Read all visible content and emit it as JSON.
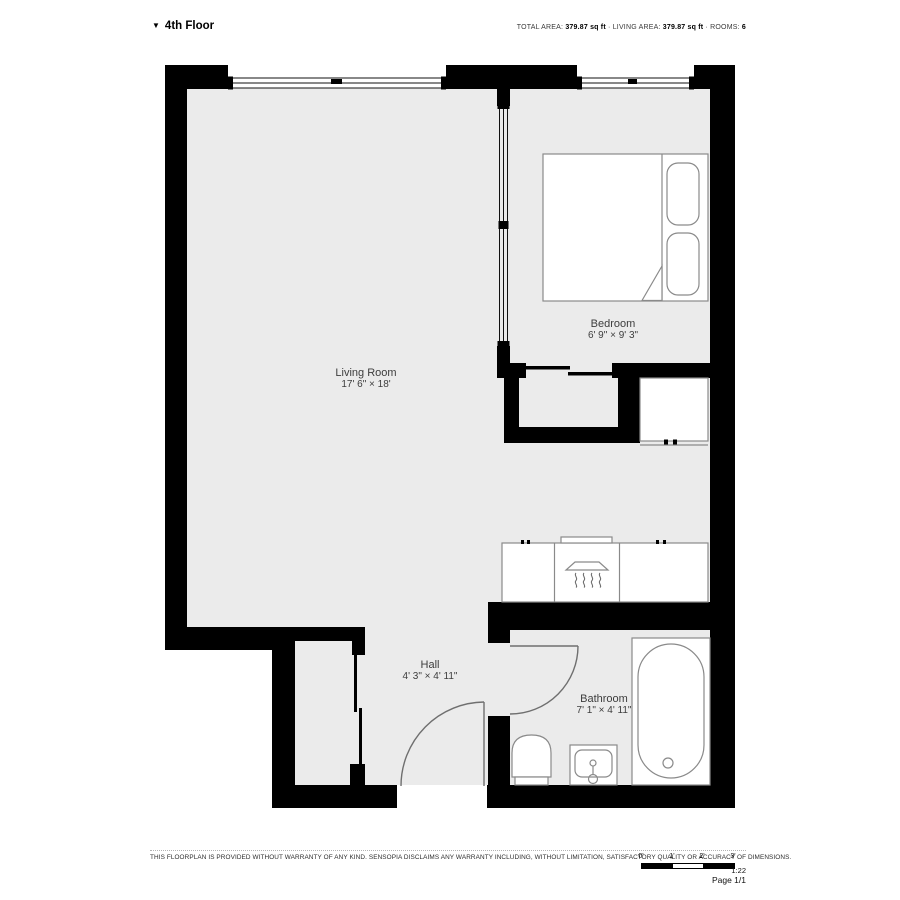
{
  "header": {
    "floor_label": "4th Floor",
    "collapse_icon": "▼",
    "stats": {
      "total_area_label": "TOTAL AREA:",
      "total_area_value": "379.87 sq ft",
      "sep1": "·",
      "living_area_label": "LIVING AREA:",
      "living_area_value": "379.87 sq ft",
      "sep2": "·",
      "rooms_label": "ROOMS:",
      "rooms_value": "6"
    }
  },
  "rooms": [
    {
      "name": "Living Room",
      "dims": "17' 6\" × 18'"
    },
    {
      "name": "Bedroom",
      "dims": "6' 9\" × 9' 3\""
    },
    {
      "name": "Hall",
      "dims": "4' 3\" × 4' 11\""
    },
    {
      "name": "Bathroom",
      "dims": "7' 1\" × 4' 11\""
    }
  ],
  "footer": {
    "disclaimer": "THIS FLOORPLAN IS PROVIDED WITHOUT WARRANTY OF ANY KIND. SENSOPIA DISCLAIMS ANY WARRANTY INCLUDING, WITHOUT LIMITATION, SATISFACTORY QUALITY OR ACCURACY OF DIMENSIONS.",
    "scale": {
      "ticks": [
        "0'",
        "1'",
        "2'",
        "3'"
      ],
      "ratio": "1:22"
    },
    "page": "Page 1/1"
  },
  "colors": {
    "wall": "#000000",
    "floor": "#ebebeb",
    "fixture_outline": "#8a8a8a",
    "label_text": "#3d3d3d"
  }
}
